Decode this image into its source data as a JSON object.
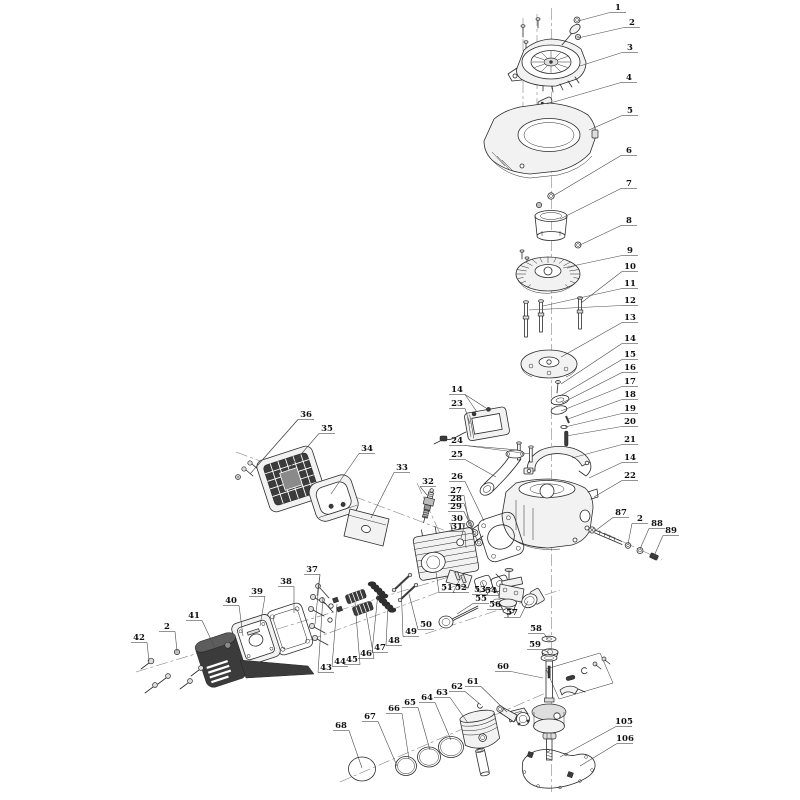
{
  "diagram": {
    "kind": "engine-exploded-parts-diagram",
    "background": "#ffffff",
    "line_color": "#2b2b2b",
    "label_color": "#111111",
    "label_font_size": 8.5
  },
  "callouts": [
    {
      "n": "1",
      "x": 610,
      "y": 10,
      "tx": 578,
      "ty": 21
    },
    {
      "n": "2",
      "x": 624,
      "y": 25,
      "tx": 578,
      "ty": 38
    },
    {
      "n": "3",
      "x": 622,
      "y": 50,
      "tx": 580,
      "ty": 66
    },
    {
      "n": "4",
      "x": 621,
      "y": 80,
      "tx": 547,
      "ty": 104
    },
    {
      "n": "5",
      "x": 622,
      "y": 113,
      "tx": 589,
      "ty": 130
    },
    {
      "n": "6",
      "x": 621,
      "y": 153,
      "tx": 553,
      "ty": 196
    },
    {
      "n": "7",
      "x": 621,
      "y": 186,
      "tx": 560,
      "ty": 219
    },
    {
      "n": "8",
      "x": 621,
      "y": 223,
      "tx": 580,
      "ty": 245
    },
    {
      "n": "9",
      "x": 622,
      "y": 253,
      "tx": 563,
      "ty": 268
    },
    {
      "n": "10",
      "x": 622,
      "y": 269,
      "tx": 581,
      "ty": 303
    },
    {
      "n": "11",
      "x": 622,
      "y": 286,
      "tx": 543,
      "ty": 306
    },
    {
      "n": "12",
      "x": 622,
      "y": 303,
      "tx": 529,
      "ty": 310
    },
    {
      "n": "13",
      "x": 622,
      "y": 320,
      "tx": 561,
      "ty": 357
    },
    {
      "n": "14",
      "x": 622,
      "y": 341,
      "tx": 561,
      "ty": 384
    },
    {
      "n": "15",
      "x": 622,
      "y": 357,
      "tx": 560,
      "ty": 396
    },
    {
      "n": "16",
      "x": 622,
      "y": 370,
      "tx": 562,
      "ty": 403
    },
    {
      "n": "17",
      "x": 622,
      "y": 384,
      "tx": 561,
      "ty": 411
    },
    {
      "n": "18",
      "x": 622,
      "y": 397,
      "tx": 568,
      "ty": 419
    },
    {
      "n": "19",
      "x": 622,
      "y": 411,
      "tx": 565,
      "ty": 427
    },
    {
      "n": "20",
      "x": 622,
      "y": 424,
      "tx": 566,
      "ty": 436
    },
    {
      "n": "21",
      "x": 622,
      "y": 442,
      "tx": 572,
      "ty": 458
    },
    {
      "n": "14",
      "x": 622,
      "y": 460,
      "tx": 589,
      "ty": 478
    },
    {
      "n": "22",
      "x": 622,
      "y": 478,
      "tx": 594,
      "ty": 497
    },
    {
      "n": "36",
      "x": 298,
      "y": 417,
      "tx": 257,
      "ty": 466,
      "tx2": 250,
      "ty2": 474
    },
    {
      "n": "35",
      "x": 319,
      "y": 431,
      "tx": 289,
      "ty": 468
    },
    {
      "n": "34",
      "x": 359,
      "y": 451,
      "tx": 331,
      "ty": 494
    },
    {
      "n": "33",
      "x": 394,
      "y": 470,
      "tx": 371,
      "ty": 518
    },
    {
      "n": "32",
      "x": 420,
      "y": 484,
      "tx": 427,
      "ty": 495
    },
    {
      "n": "14",
      "x": 449,
      "y": 392,
      "tx": 477,
      "ty": 412,
      "tx2": 489,
      "ty2": 410
    },
    {
      "n": "23",
      "x": 449,
      "y": 406,
      "tx": 470,
      "ty": 424
    },
    {
      "n": "24",
      "x": 449,
      "y": 443,
      "tx": 518,
      "ty": 450,
      "tx2": 530,
      "ty2": 454
    },
    {
      "n": "25",
      "x": 449,
      "y": 457,
      "tx": 496,
      "ty": 477
    },
    {
      "n": "26",
      "x": 449,
      "y": 479,
      "tx": 484,
      "ty": 521
    },
    {
      "n": "27",
      "x": 448,
      "y": 493,
      "tx": 469,
      "ty": 524
    },
    {
      "n": "28",
      "x": 448,
      "y": 501,
      "tx": 474,
      "ty": 533
    },
    {
      "n": "29",
      "x": 448,
      "y": 509,
      "tx": 478,
      "ty": 542
    },
    {
      "n": "30",
      "x": 449,
      "y": 521,
      "tx": 461,
      "ty": 538
    },
    {
      "n": "31",
      "x": 449,
      "y": 529,
      "tx": 466,
      "ty": 548
    },
    {
      "n": "87",
      "x": 613,
      "y": 515,
      "tx": 595,
      "ty": 531
    },
    {
      "n": "2",
      "x": 632,
      "y": 521,
      "tx": 628,
      "ty": 544
    },
    {
      "n": "88",
      "x": 649,
      "y": 526,
      "tx": 640,
      "ty": 549
    },
    {
      "n": "89",
      "x": 663,
      "y": 533,
      "tx": 654,
      "ty": 556
    },
    {
      "n": "37",
      "x": 304,
      "y": 572,
      "tx": 317,
      "ty": 596,
      "tx2": 315,
      "ty2": 624
    },
    {
      "n": "38",
      "x": 278,
      "y": 584,
      "tx": 294,
      "ty": 613
    },
    {
      "n": "39",
      "x": 249,
      "y": 594,
      "tx": 260,
      "ty": 626
    },
    {
      "n": "40",
      "x": 223,
      "y": 603,
      "tx": 243,
      "ty": 636
    },
    {
      "n": "41",
      "x": 186,
      "y": 618,
      "tx": 215,
      "ty": 648
    },
    {
      "n": "2",
      "x": 159,
      "y": 629,
      "tx": 177,
      "ty": 651
    },
    {
      "n": "42",
      "x": 131,
      "y": 640,
      "tx": 149,
      "ty": 661
    },
    {
      "n": "43",
      "x": 318,
      "y": 670,
      "tx": 323,
      "ty": 597
    },
    {
      "n": "44",
      "x": 332,
      "y": 664,
      "tx": 337,
      "ty": 604
    },
    {
      "n": "45",
      "x": 344,
      "y": 662,
      "tx": 355,
      "ty": 602
    },
    {
      "n": "46",
      "x": 358,
      "y": 656,
      "tx": 366,
      "ty": 612
    },
    {
      "n": "47",
      "x": 372,
      "y": 650,
      "tx": 378,
      "ty": 593
    },
    {
      "n": "48",
      "x": 386,
      "y": 643,
      "tx": 388,
      "ty": 605
    },
    {
      "n": "49",
      "x": 403,
      "y": 634,
      "tx": 401,
      "ty": 582
    },
    {
      "n": "50",
      "x": 418,
      "y": 627,
      "tx": 409,
      "ty": 594
    },
    {
      "n": "51",
      "x": 439,
      "y": 590,
      "tx": 436,
      "ty": 572
    },
    {
      "n": "52",
      "x": 453,
      "y": 590,
      "tx": 460,
      "ty": 579
    },
    {
      "n": "53",
      "x": 472,
      "y": 592,
      "tx": 482,
      "ty": 582
    },
    {
      "n": "54",
      "x": 483,
      "y": 593,
      "tx": 495,
      "ty": 587
    },
    {
      "n": "55",
      "x": 473,
      "y": 601,
      "tx": 457,
      "ty": 614
    },
    {
      "n": "56",
      "x": 487,
      "y": 607,
      "tx": 498,
      "ty": 603
    },
    {
      "n": "57",
      "x": 504,
      "y": 615,
      "tx": 528,
      "ty": 601
    },
    {
      "n": "58",
      "x": 528,
      "y": 631,
      "tx": 548,
      "ty": 639
    },
    {
      "n": "59",
      "x": 527,
      "y": 647,
      "tx": 549,
      "ty": 653
    },
    {
      "n": "60",
      "x": 495,
      "y": 669,
      "tx": 543,
      "ty": 678
    },
    {
      "n": "61",
      "x": 465,
      "y": 684,
      "tx": 507,
      "ty": 712
    },
    {
      "n": "62",
      "x": 449,
      "y": 689,
      "tx": 481,
      "ty": 705
    },
    {
      "n": "63",
      "x": 434,
      "y": 695,
      "tx": 468,
      "ty": 723
    },
    {
      "n": "64",
      "x": 419,
      "y": 700,
      "tx": 451,
      "ty": 740
    },
    {
      "n": "65",
      "x": 402,
      "y": 705,
      "tx": 430,
      "ty": 750
    },
    {
      "n": "66",
      "x": 386,
      "y": 711,
      "tx": 409,
      "ty": 759
    },
    {
      "n": "67",
      "x": 362,
      "y": 719,
      "tx": 397,
      "ty": 766
    },
    {
      "n": "68",
      "x": 333,
      "y": 728,
      "tx": 362,
      "ty": 768
    },
    {
      "n": "105",
      "x": 616,
      "y": 724,
      "tx": 560,
      "ty": 757
    },
    {
      "n": "106",
      "x": 617,
      "y": 741,
      "tx": 580,
      "ty": 766
    }
  ]
}
